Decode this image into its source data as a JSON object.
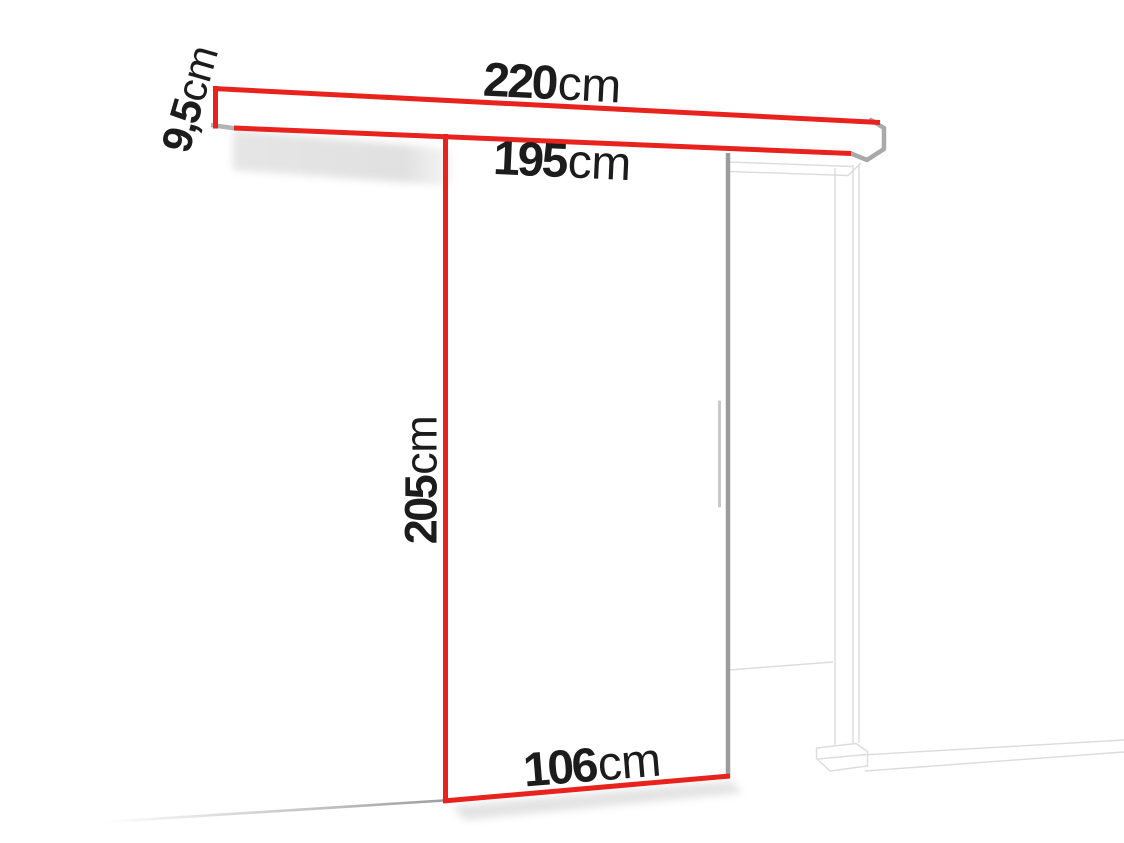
{
  "diagram": {
    "description": "Sliding door with wall rail and door frame, annotated with dimensions",
    "colors": {
      "dimension_line": "#e8231d",
      "door_edge": "#9b9b9b",
      "frame_line": "#dcdcdc",
      "end_cap": "#a9a9a9",
      "text": "#1c1c1c",
      "background": "#ffffff"
    },
    "labels": {
      "rail_total_length": {
        "value": "220",
        "unit": "cm"
      },
      "rail_track_length": {
        "value": "195",
        "unit": "cm"
      },
      "rail_height": {
        "value": "9,5",
        "unit": "cm"
      },
      "door_height": {
        "value": "205",
        "unit": "cm"
      },
      "door_width": {
        "value": "106",
        "unit": "cm"
      }
    }
  }
}
